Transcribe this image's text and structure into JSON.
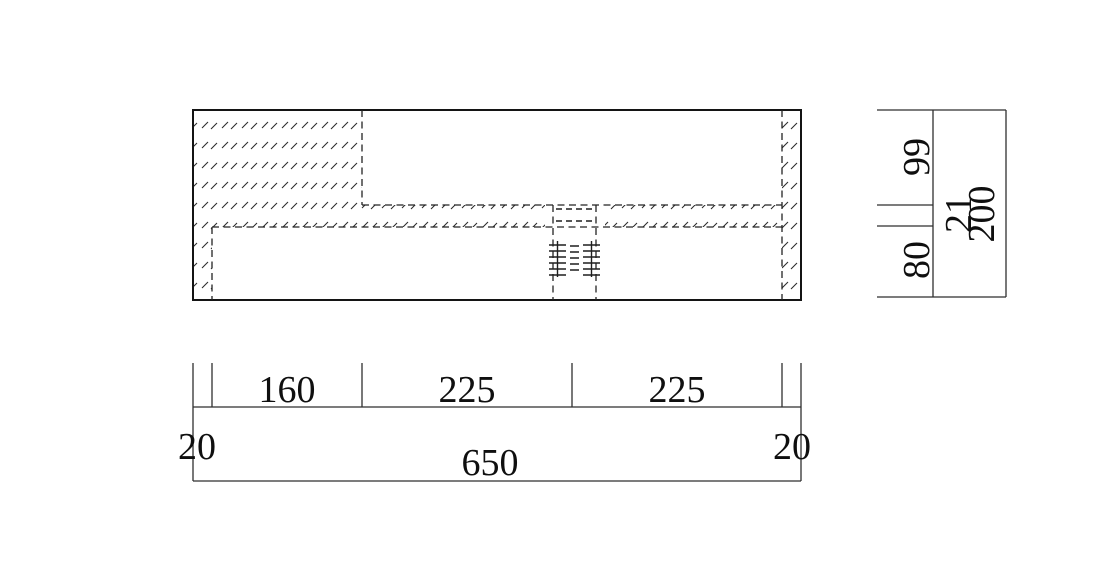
{
  "page": {
    "background": "#ffffff",
    "line_color": "#141414",
    "hatch_color": "#2e2e2e"
  },
  "drawing": {
    "kind": "technical-section-drawing",
    "views": {
      "section": "hatched cross-section with central threaded hole shown hidden",
      "right_dimension_strip": "vertical dimension chain",
      "bottom_dimension_strip": "horizontal dimension chain"
    }
  },
  "dimensions": {
    "bottom": {
      "segments": [
        "20",
        "160",
        "225",
        "225",
        "20"
      ],
      "overall": "650"
    },
    "right": {
      "segments": [
        "99",
        "21",
        "80"
      ],
      "overall": "200"
    }
  }
}
